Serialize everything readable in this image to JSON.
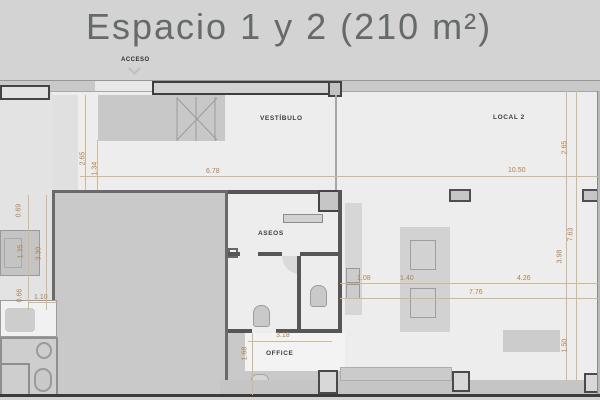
{
  "title": "Espacio 1 y 2 (210 m²)",
  "labels": {
    "acceso": "ACCESO",
    "vestibulo": "VESTÍBULO",
    "local2": "LOCAL 2",
    "aseos": "ASEOS",
    "office": "OFFICE"
  },
  "dimensions": {
    "left_top_height": "2.65",
    "left_top_inner": "1.34",
    "vestibulo_width": "6.78",
    "local2_width": "10.50",
    "right_top_height": "2.65",
    "left_chain_top": "0.69",
    "left_chain_mid": "1.35",
    "left_inner_height": "3.30",
    "left_chain_bottom": "0.66",
    "left_shaft_width": "1.10",
    "mid_chain_1": "1.08",
    "mid_chain_2": "1.40",
    "mid_chain_3": "4.26",
    "local2_inner_width": "7.76",
    "right_chain_upper": "3.98",
    "right_total_height": "7.63",
    "office_width": "3.18",
    "office_height": "1.68",
    "right_chain_lower": "1.50"
  },
  "colors": {
    "background": "#d3d3d3",
    "plan_floor": "#ededed",
    "wall_dark": "#565656",
    "gray_fill": "#c9c9c9",
    "dimension_text": "#b2804e",
    "label_text": "#3d3d3d",
    "title_text": "#666a6a"
  }
}
